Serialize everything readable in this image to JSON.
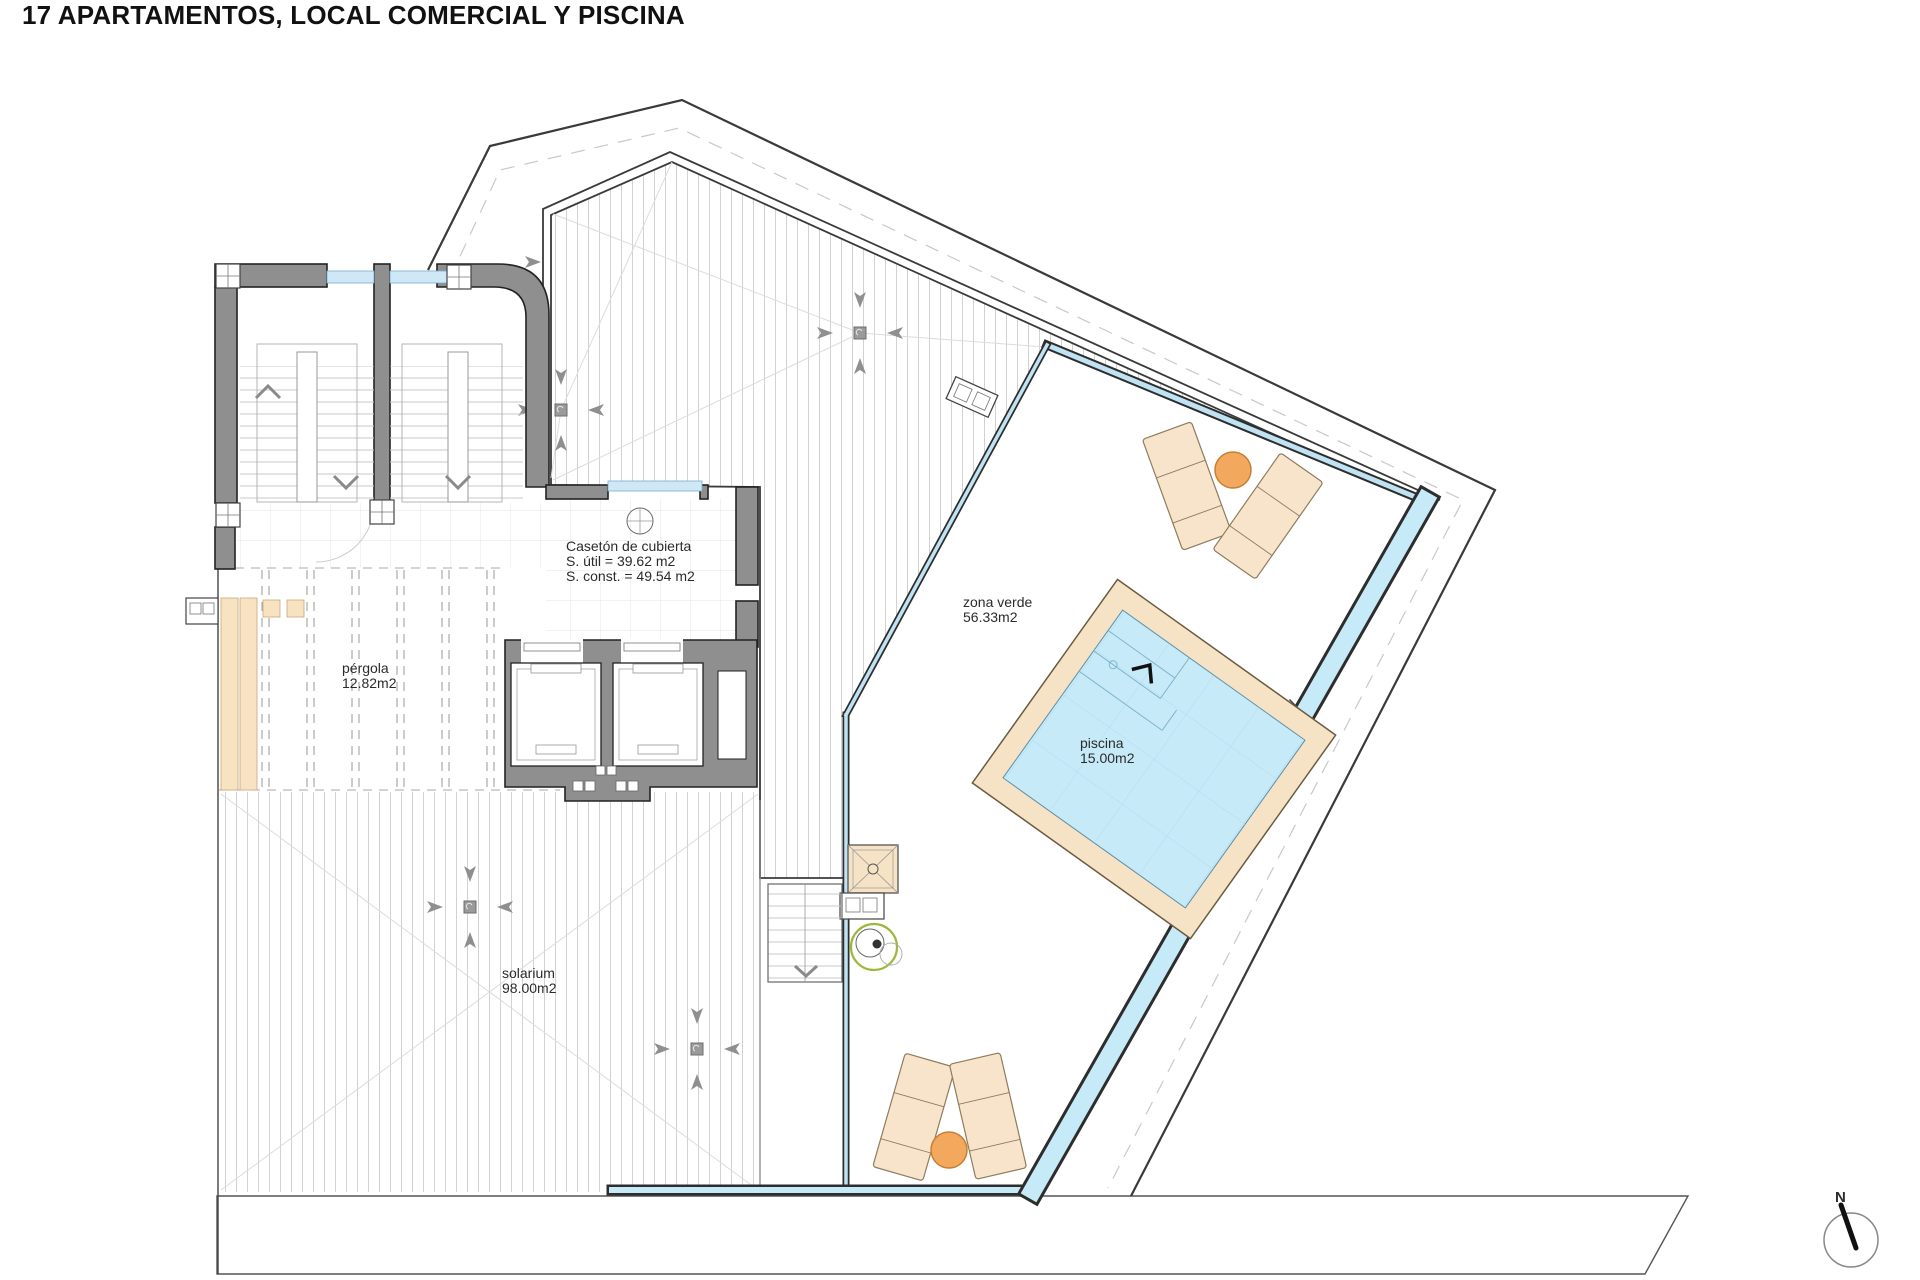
{
  "title": "17 APARTAMENTOS, LOCAL COMERCIAL Y PISCINA",
  "areas": {
    "caseton": {
      "lines": [
        "Casetón de cubierta",
        "S. útil = 39.62 m2",
        "S. const. = 49.54 m2"
      ]
    },
    "zona_verde": {
      "lines": [
        "zona verde",
        "56.33m2"
      ]
    },
    "piscina": {
      "lines": [
        "piscina",
        "15.00m2"
      ]
    },
    "pergola": {
      "lines": [
        "pérgola",
        "12.82m2"
      ]
    },
    "solarium": {
      "lines": [
        "solarium",
        "98.00m2"
      ]
    }
  },
  "compass": {
    "north_label": "N"
  },
  "colors": {
    "wall_gray": "#8f8f8f",
    "outline_dark": "#2d2d2d",
    "water_blue": "#c7eaf8",
    "glass_blue": "#bfe3f2",
    "deck_tan": "#f6e3c6",
    "lounger_tan": "#f8e4ca",
    "table_orange": "#f3a95d",
    "plant_green": "#9ab83a"
  }
}
